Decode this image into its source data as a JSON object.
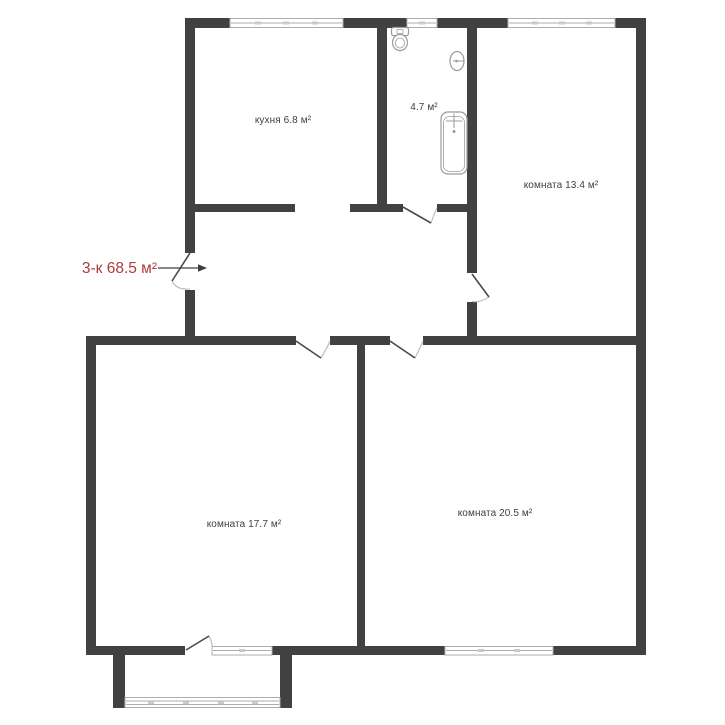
{
  "title": "3-к 68.5 м²",
  "labels": {
    "kitchen": "кухня 6.8 м²",
    "bathroom": "4.7 м²",
    "room_13": "комната 13.4 м²",
    "room_17": "комната 17.7 м²",
    "room_20": "комната 20.5 м²"
  },
  "colors": {
    "wall": "#414144",
    "window_frame": "#adadad",
    "window_tick": "#c9c9c9",
    "fixture": "#9b9b9b",
    "door": "#4a4a4d",
    "door_arc": "#b5b5b5",
    "text": "#3f3f3f",
    "accent": "#b23a3c",
    "background": "#ffffff"
  }
}
